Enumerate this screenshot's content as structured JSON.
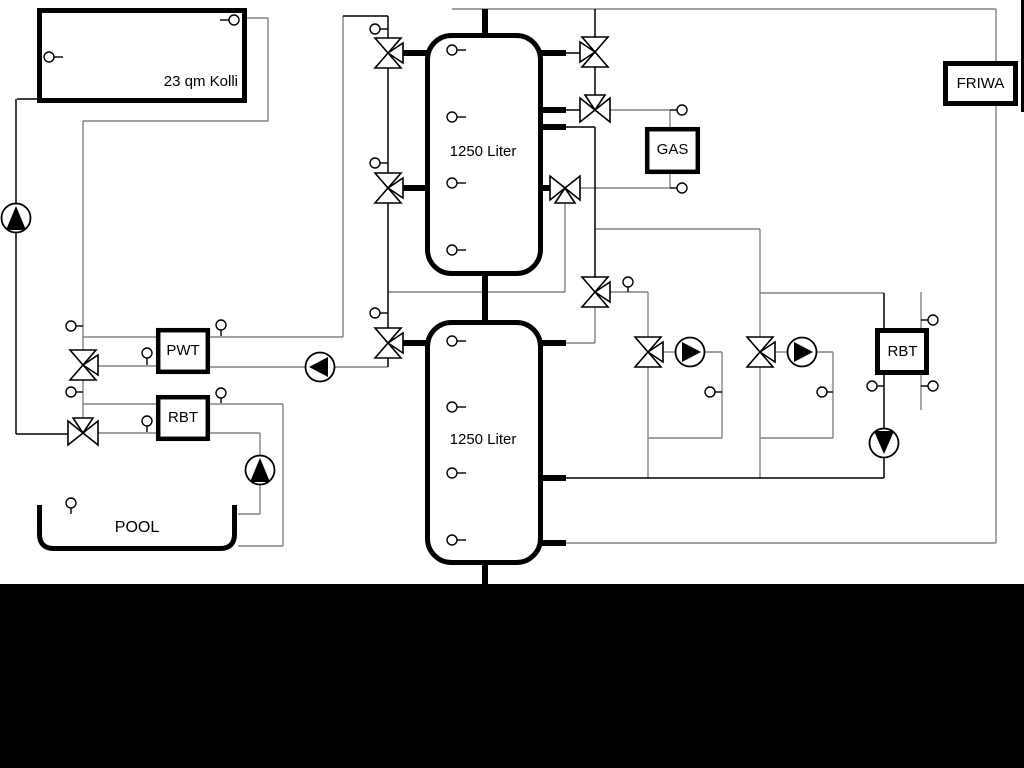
{
  "diagram": {
    "collector": {
      "label": "23 qm Kolli"
    },
    "tank_top": {
      "label": "1250 Liter"
    },
    "tank_bottom": {
      "label": "1250 Liter"
    },
    "pwt": {
      "label": "PWT"
    },
    "rbt_left": {
      "label": "RBT"
    },
    "rbt_right": {
      "label": "RBT"
    },
    "gas": {
      "label": "GAS"
    },
    "friwa": {
      "label": "FRIWA"
    },
    "pool": {
      "label": "POOL"
    }
  },
  "colors": {
    "line_gray": "#828282",
    "line_black": "#000000",
    "vessel_stroke": "#000000",
    "background": "#ffffff",
    "band": "#000000"
  }
}
